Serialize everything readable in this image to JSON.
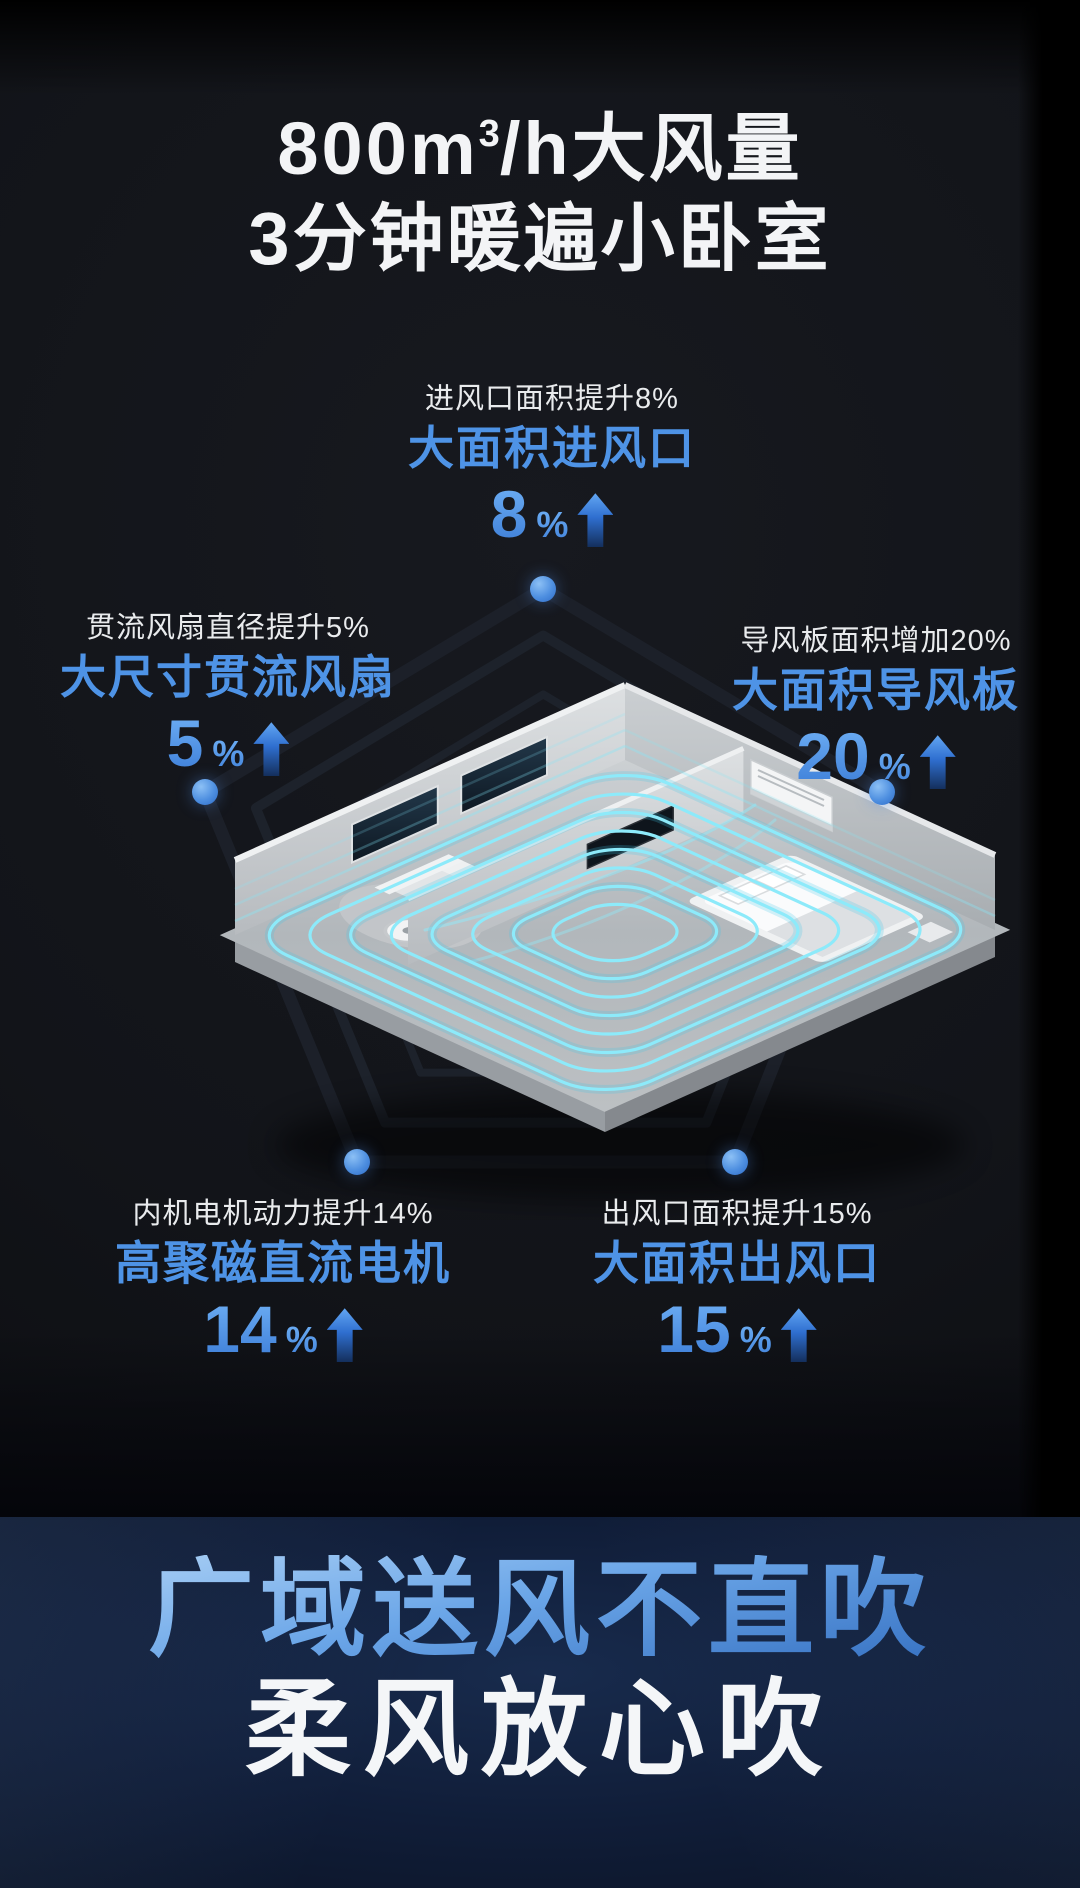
{
  "title": {
    "prefix": "800m",
    "sup": "3",
    "suffix": "/h大风量",
    "line2": "3分钟暖遍小卧室"
  },
  "stats": [
    {
      "position": "top",
      "label": "进风口面积提升8%",
      "name": "大面积进风口",
      "value": "8",
      "unit": "%"
    },
    {
      "position": "left",
      "label": "贯流风扇直径提升5%",
      "name": "大尺寸贯流风扇",
      "value": "5",
      "unit": "%"
    },
    {
      "position": "right",
      "label": "导风板面积增加20%",
      "name": "大面积导风板",
      "value": "20",
      "unit": "%"
    },
    {
      "position": "bottom-left",
      "label": "内机电机动力提升14%",
      "name": "高聚磁直流电机",
      "value": "14",
      "unit": "%"
    },
    {
      "position": "bottom-right",
      "label": "出风口面积提升15%",
      "name": "大面积出风口",
      "value": "15",
      "unit": "%"
    }
  ],
  "banner": {
    "line1": "广域送风不直吹",
    "line2": "柔风放心吹"
  },
  "icons": {
    "up_arrow": "up-arrow",
    "vertex_dot": "pentagon-vertex-dot"
  },
  "colors": {
    "accent_blue": "#4e93e6",
    "label_white": "#e9ebed",
    "airflow_cyan": "#8deafa",
    "banner_text_top": "#b4d6f7",
    "banner_text_bottom": "#2c67bb",
    "banner_bg": "#101d38",
    "main_bg": "#121419"
  }
}
